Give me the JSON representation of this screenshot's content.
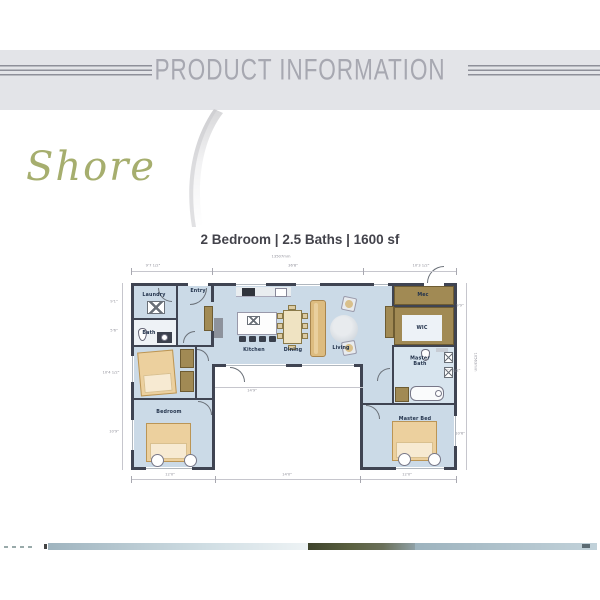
{
  "header": {
    "title": "PRODUCT INFORMATION"
  },
  "logo": {
    "text": "Shore"
  },
  "summary": {
    "line": "2 Bedroom | 2.5 Baths | 1600 sf"
  },
  "floorplan": {
    "rooms": [
      {
        "id": "laundry",
        "label": "Laundry"
      },
      {
        "id": "entry",
        "label": "Entry"
      },
      {
        "id": "bath",
        "label": "Bath"
      },
      {
        "id": "bedroom",
        "label": "Bedroom"
      },
      {
        "id": "kitchen",
        "label": "Kitchen"
      },
      {
        "id": "dining",
        "label": "Dining"
      },
      {
        "id": "living",
        "label": "Living"
      },
      {
        "id": "mec",
        "label": "Mec"
      },
      {
        "id": "wic",
        "label": "WIC"
      },
      {
        "id": "master_bath",
        "label": "Master Bath"
      },
      {
        "id": "master_bed",
        "label": "Master Bed"
      }
    ],
    "dimensions": {
      "overall_width": "13507mm",
      "overall_height": "10563mm",
      "top": [
        "9'7 1/2\"",
        "36'8\"",
        "10'3 1/2\""
      ],
      "left": [
        "9'1\"",
        "5'6\"",
        "10'4 1/2\"",
        "10'9\""
      ],
      "right": [
        "9'9\"",
        "11'1 1/2\"",
        "10'6\""
      ],
      "bottom": [
        "12'0\"",
        "14'0\"",
        "12'0\""
      ],
      "inner": [
        "14'9\""
      ]
    },
    "colors": {
      "wall": "#3f4452",
      "floor": "#cbdae7",
      "closet": "#a18a54",
      "accent": "#24344d"
    }
  }
}
